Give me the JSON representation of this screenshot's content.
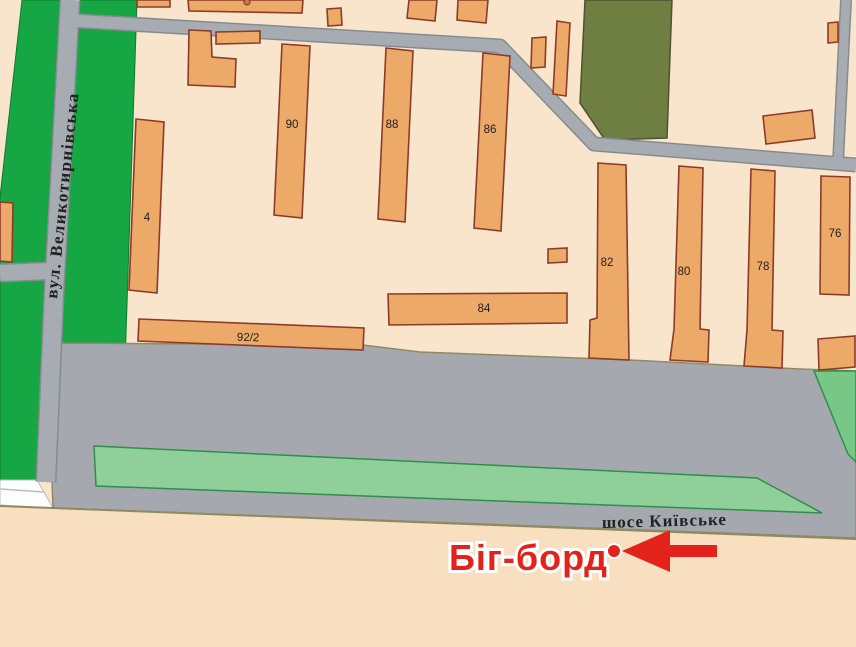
{
  "map": {
    "street_label": "вул. Великотирнівська",
    "highway_label": "шосе Київське",
    "billboard_label": "Біг-борд",
    "buildings": {
      "b4": "4",
      "b90": "90",
      "b88": "88",
      "b86": "86",
      "b84": "84",
      "b82": "82",
      "b80": "80",
      "b78": "78",
      "b76": "76",
      "b92_2": "92/2"
    },
    "colors": {
      "background": "#f8e5cb",
      "background_south": "#f7dfc0",
      "building_fill": "#eda968",
      "building_outline": "#8c3b2b",
      "park_green": "#16a643",
      "olive_green": "#6e7f41",
      "lawn_green": "#8fcf9a",
      "wedge_green": "#79c787",
      "road_gray": "#a7acb2",
      "road_edge": "#868b92",
      "zone_gray": "#a5a9af",
      "boundary_line": "#8f8a62",
      "accent_red": "#e3231b",
      "label_dark": "#1f1f1f"
    }
  }
}
